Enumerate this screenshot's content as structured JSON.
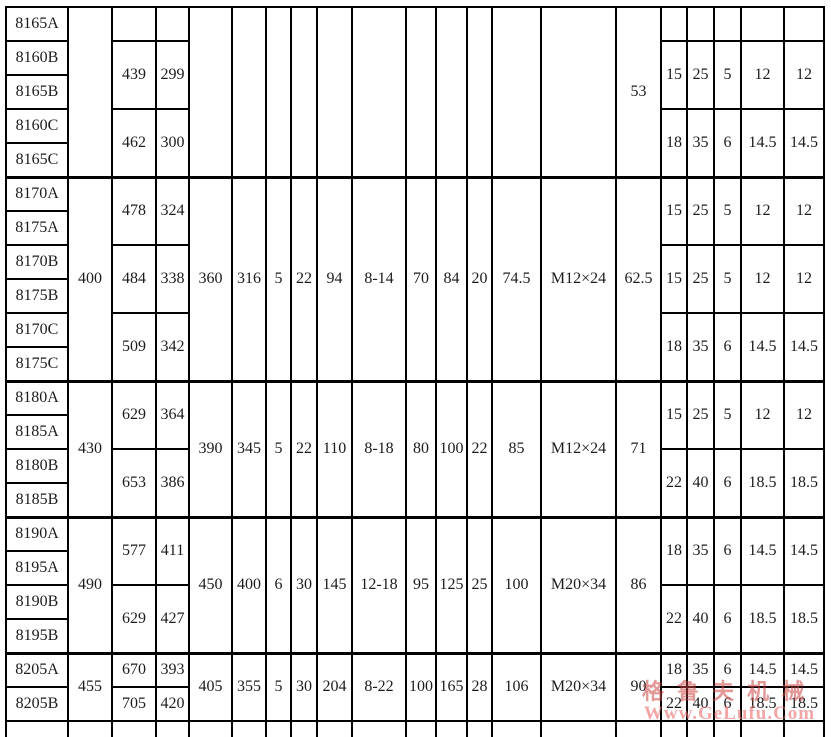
{
  "colors": {
    "grid_line": "#000000",
    "text": "#1c1c1c",
    "background": "#ffffff"
  },
  "watermark": {
    "line1": "格鲁夫机械",
    "line2": "Www.GeLufu.Com"
  },
  "table": {
    "column_count": 21,
    "column_widths": [
      62,
      44,
      44,
      33,
      43,
      34,
      25,
      26,
      35,
      54,
      30,
      31,
      25,
      49,
      75,
      45,
      26,
      27,
      27,
      43,
      40
    ],
    "default_row_height": 34,
    "rows": [
      {
        "name": "row-8165A",
        "block": false,
        "cells": [
          {
            "c": 1,
            "v": "8165A",
            "rs": 1
          },
          {
            "c": 2,
            "v": "",
            "rs": 5
          },
          {
            "c": 3,
            "v": "",
            "rs": 1
          },
          {
            "c": 4,
            "v": "",
            "rs": 1
          },
          {
            "c": 5,
            "v": "",
            "rs": 5
          },
          {
            "c": 6,
            "v": "",
            "rs": 5
          },
          {
            "c": 7,
            "v": "",
            "rs": 5
          },
          {
            "c": 8,
            "v": "",
            "rs": 5
          },
          {
            "c": 9,
            "v": "",
            "rs": 5
          },
          {
            "c": 10,
            "v": "",
            "rs": 5
          },
          {
            "c": 11,
            "v": "",
            "rs": 5
          },
          {
            "c": 12,
            "v": "",
            "rs": 5
          },
          {
            "c": 13,
            "v": "",
            "rs": 5
          },
          {
            "c": 14,
            "v": "",
            "rs": 5
          },
          {
            "c": 15,
            "v": "",
            "rs": 5
          },
          {
            "c": 16,
            "v": "53",
            "rs": 5,
            "top": true
          },
          {
            "c": 17,
            "v": "",
            "rs": 1
          },
          {
            "c": 18,
            "v": "",
            "rs": 1
          },
          {
            "c": 19,
            "v": "",
            "rs": 1
          },
          {
            "c": 20,
            "v": "",
            "rs": 1
          },
          {
            "c": 21,
            "v": "",
            "rs": 1
          }
        ]
      },
      {
        "name": "row-8160B",
        "block": false,
        "cells": [
          {
            "c": 1,
            "v": "8160B",
            "rs": 1
          },
          {
            "c": 3,
            "v": "439",
            "rs": 2
          },
          {
            "c": 4,
            "v": "299",
            "rs": 2
          },
          {
            "c": 17,
            "v": "15",
            "rs": 2
          },
          {
            "c": 18,
            "v": "25",
            "rs": 2
          },
          {
            "c": 19,
            "v": "5",
            "rs": 2
          },
          {
            "c": 20,
            "v": "12",
            "rs": 2
          },
          {
            "c": 21,
            "v": "12",
            "rs": 2
          }
        ]
      },
      {
        "name": "row-8165B",
        "block": false,
        "cells": [
          {
            "c": 1,
            "v": "8165B",
            "rs": 1
          }
        ]
      },
      {
        "name": "row-8160C",
        "block": false,
        "cells": [
          {
            "c": 1,
            "v": "8160C",
            "rs": 1
          },
          {
            "c": 3,
            "v": "462",
            "rs": 2
          },
          {
            "c": 4,
            "v": "300",
            "rs": 2
          },
          {
            "c": 17,
            "v": "18",
            "rs": 2
          },
          {
            "c": 18,
            "v": "35",
            "rs": 2
          },
          {
            "c": 19,
            "v": "6",
            "rs": 2
          },
          {
            "c": 20,
            "v": "14.5",
            "rs": 2
          },
          {
            "c": 21,
            "v": "14.5",
            "rs": 2
          }
        ]
      },
      {
        "name": "row-8165C",
        "block": false,
        "cells": [
          {
            "c": 1,
            "v": "8165C",
            "rs": 1
          }
        ]
      },
      {
        "name": "row-8170A",
        "block": true,
        "cells": [
          {
            "c": 1,
            "v": "8170A",
            "rs": 1
          },
          {
            "c": 2,
            "v": "400",
            "rs": 6
          },
          {
            "c": 3,
            "v": "478",
            "rs": 2
          },
          {
            "c": 4,
            "v": "324",
            "rs": 2
          },
          {
            "c": 5,
            "v": "360",
            "rs": 6
          },
          {
            "c": 6,
            "v": "316",
            "rs": 6
          },
          {
            "c": 7,
            "v": "5",
            "rs": 6
          },
          {
            "c": 8,
            "v": "22",
            "rs": 6
          },
          {
            "c": 9,
            "v": "94",
            "rs": 6
          },
          {
            "c": 10,
            "v": "8-14",
            "rs": 6
          },
          {
            "c": 11,
            "v": "70",
            "rs": 6
          },
          {
            "c": 12,
            "v": "84",
            "rs": 6
          },
          {
            "c": 13,
            "v": "20",
            "rs": 6
          },
          {
            "c": 14,
            "v": "74.5",
            "rs": 6
          },
          {
            "c": 15,
            "v": "M12×24",
            "rs": 6
          },
          {
            "c": 16,
            "v": "62.5",
            "rs": 6
          },
          {
            "c": 17,
            "v": "15",
            "rs": 2
          },
          {
            "c": 18,
            "v": "25",
            "rs": 2
          },
          {
            "c": 19,
            "v": "5",
            "rs": 2
          },
          {
            "c": 20,
            "v": "12",
            "rs": 2
          },
          {
            "c": 21,
            "v": "12",
            "rs": 2
          }
        ]
      },
      {
        "name": "row-8175A",
        "block": false,
        "cells": [
          {
            "c": 1,
            "v": "8175A",
            "rs": 1
          }
        ]
      },
      {
        "name": "row-8170B",
        "block": false,
        "cells": [
          {
            "c": 1,
            "v": "8170B",
            "rs": 1
          },
          {
            "c": 3,
            "v": "484",
            "rs": 2
          },
          {
            "c": 4,
            "v": "338",
            "rs": 2
          },
          {
            "c": 17,
            "v": "15",
            "rs": 2
          },
          {
            "c": 18,
            "v": "25",
            "rs": 2
          },
          {
            "c": 19,
            "v": "5",
            "rs": 2
          },
          {
            "c": 20,
            "v": "12",
            "rs": 2
          },
          {
            "c": 21,
            "v": "12",
            "rs": 2
          }
        ]
      },
      {
        "name": "row-8175B",
        "block": false,
        "cells": [
          {
            "c": 1,
            "v": "8175B",
            "rs": 1
          }
        ]
      },
      {
        "name": "row-8170C",
        "block": false,
        "cells": [
          {
            "c": 1,
            "v": "8170C",
            "rs": 1
          },
          {
            "c": 3,
            "v": "509",
            "rs": 2
          },
          {
            "c": 4,
            "v": "342",
            "rs": 2
          },
          {
            "c": 17,
            "v": "18",
            "rs": 2
          },
          {
            "c": 18,
            "v": "35",
            "rs": 2
          },
          {
            "c": 19,
            "v": "6",
            "rs": 2
          },
          {
            "c": 20,
            "v": "14.5",
            "rs": 2
          },
          {
            "c": 21,
            "v": "14.5",
            "rs": 2
          }
        ]
      },
      {
        "name": "row-8175C",
        "block": false,
        "cells": [
          {
            "c": 1,
            "v": "8175C",
            "rs": 1
          }
        ]
      },
      {
        "name": "row-8180A",
        "block": true,
        "cells": [
          {
            "c": 1,
            "v": "8180A",
            "rs": 1
          },
          {
            "c": 2,
            "v": "430",
            "rs": 4
          },
          {
            "c": 3,
            "v": "629",
            "rs": 2
          },
          {
            "c": 4,
            "v": "364",
            "rs": 2
          },
          {
            "c": 5,
            "v": "390",
            "rs": 4
          },
          {
            "c": 6,
            "v": "345",
            "rs": 4
          },
          {
            "c": 7,
            "v": "5",
            "rs": 4
          },
          {
            "c": 8,
            "v": "22",
            "rs": 4
          },
          {
            "c": 9,
            "v": "110",
            "rs": 4
          },
          {
            "c": 10,
            "v": "8-18",
            "rs": 4
          },
          {
            "c": 11,
            "v": "80",
            "rs": 4
          },
          {
            "c": 12,
            "v": "100",
            "rs": 4
          },
          {
            "c": 13,
            "v": "22",
            "rs": 4
          },
          {
            "c": 14,
            "v": "85",
            "rs": 4
          },
          {
            "c": 15,
            "v": "M12×24",
            "rs": 4
          },
          {
            "c": 16,
            "v": "71",
            "rs": 4
          },
          {
            "c": 17,
            "v": "15",
            "rs": 2
          },
          {
            "c": 18,
            "v": "25",
            "rs": 2
          },
          {
            "c": 19,
            "v": "5",
            "rs": 2
          },
          {
            "c": 20,
            "v": "12",
            "rs": 2
          },
          {
            "c": 21,
            "v": "12",
            "rs": 2
          }
        ]
      },
      {
        "name": "row-8185A",
        "block": false,
        "cells": [
          {
            "c": 1,
            "v": "8185A",
            "rs": 1
          }
        ]
      },
      {
        "name": "row-8180B",
        "block": false,
        "cells": [
          {
            "c": 1,
            "v": "8180B",
            "rs": 1
          },
          {
            "c": 3,
            "v": "653",
            "rs": 2
          },
          {
            "c": 4,
            "v": "386",
            "rs": 2
          },
          {
            "c": 17,
            "v": "22",
            "rs": 2
          },
          {
            "c": 18,
            "v": "40",
            "rs": 2
          },
          {
            "c": 19,
            "v": "6",
            "rs": 2
          },
          {
            "c": 20,
            "v": "18.5",
            "rs": 2
          },
          {
            "c": 21,
            "v": "18.5",
            "rs": 2
          }
        ]
      },
      {
        "name": "row-8185B",
        "block": false,
        "cells": [
          {
            "c": 1,
            "v": "8185B",
            "rs": 1
          }
        ]
      },
      {
        "name": "row-8190A",
        "block": true,
        "cells": [
          {
            "c": 1,
            "v": "8190A",
            "rs": 1
          },
          {
            "c": 2,
            "v": "490",
            "rs": 4
          },
          {
            "c": 3,
            "v": "577",
            "rs": 2
          },
          {
            "c": 4,
            "v": "411",
            "rs": 2
          },
          {
            "c": 5,
            "v": "450",
            "rs": 4
          },
          {
            "c": 6,
            "v": "400",
            "rs": 4
          },
          {
            "c": 7,
            "v": "6",
            "rs": 4
          },
          {
            "c": 8,
            "v": "30",
            "rs": 4
          },
          {
            "c": 9,
            "v": "145",
            "rs": 4
          },
          {
            "c": 10,
            "v": "12-18",
            "rs": 4
          },
          {
            "c": 11,
            "v": "95",
            "rs": 4
          },
          {
            "c": 12,
            "v": "125",
            "rs": 4
          },
          {
            "c": 13,
            "v": "25",
            "rs": 4
          },
          {
            "c": 14,
            "v": "100",
            "rs": 4
          },
          {
            "c": 15,
            "v": "M20×34",
            "rs": 4
          },
          {
            "c": 16,
            "v": "86",
            "rs": 4
          },
          {
            "c": 17,
            "v": "18",
            "rs": 2
          },
          {
            "c": 18,
            "v": "35",
            "rs": 2
          },
          {
            "c": 19,
            "v": "6",
            "rs": 2
          },
          {
            "c": 20,
            "v": "14.5",
            "rs": 2
          },
          {
            "c": 21,
            "v": "14.5",
            "rs": 2
          }
        ]
      },
      {
        "name": "row-8195A",
        "block": false,
        "cells": [
          {
            "c": 1,
            "v": "8195A",
            "rs": 1
          }
        ]
      },
      {
        "name": "row-8190B",
        "block": false,
        "cells": [
          {
            "c": 1,
            "v": "8190B",
            "rs": 1
          },
          {
            "c": 3,
            "v": "629",
            "rs": 2
          },
          {
            "c": 4,
            "v": "427",
            "rs": 2
          },
          {
            "c": 17,
            "v": "22",
            "rs": 2
          },
          {
            "c": 18,
            "v": "40",
            "rs": 2
          },
          {
            "c": 19,
            "v": "6",
            "rs": 2
          },
          {
            "c": 20,
            "v": "18.5",
            "rs": 2
          },
          {
            "c": 21,
            "v": "18.5",
            "rs": 2
          }
        ]
      },
      {
        "name": "row-8195B",
        "block": false,
        "cells": [
          {
            "c": 1,
            "v": "8195B",
            "rs": 1
          }
        ]
      },
      {
        "name": "row-8205A",
        "block": true,
        "cells": [
          {
            "c": 1,
            "v": "8205A",
            "rs": 1
          },
          {
            "c": 2,
            "v": "455",
            "rs": 2
          },
          {
            "c": 3,
            "v": "670",
            "rs": 1
          },
          {
            "c": 4,
            "v": "393",
            "rs": 1
          },
          {
            "c": 5,
            "v": "405",
            "rs": 2
          },
          {
            "c": 6,
            "v": "355",
            "rs": 2
          },
          {
            "c": 7,
            "v": "5",
            "rs": 2
          },
          {
            "c": 8,
            "v": "30",
            "rs": 2
          },
          {
            "c": 9,
            "v": "204",
            "rs": 2
          },
          {
            "c": 10,
            "v": "8-22",
            "rs": 2
          },
          {
            "c": 11,
            "v": "100",
            "rs": 2
          },
          {
            "c": 12,
            "v": "165",
            "rs": 2
          },
          {
            "c": 13,
            "v": "28",
            "rs": 2
          },
          {
            "c": 14,
            "v": "106",
            "rs": 2
          },
          {
            "c": 15,
            "v": "M20×34",
            "rs": 2
          },
          {
            "c": 16,
            "v": "90",
            "rs": 2
          },
          {
            "c": 17,
            "v": "18",
            "rs": 1
          },
          {
            "c": 18,
            "v": "35",
            "rs": 1
          },
          {
            "c": 19,
            "v": "6",
            "rs": 1
          },
          {
            "c": 20,
            "v": "14.5",
            "rs": 1
          },
          {
            "c": 21,
            "v": "14.5",
            "rs": 1
          }
        ]
      },
      {
        "name": "row-8205B",
        "block": false,
        "cells": [
          {
            "c": 1,
            "v": "8205B",
            "rs": 1
          },
          {
            "c": 3,
            "v": "705",
            "rs": 1
          },
          {
            "c": 4,
            "v": "420",
            "rs": 1
          },
          {
            "c": 17,
            "v": "22",
            "rs": 1
          },
          {
            "c": 18,
            "v": "40",
            "rs": 1
          },
          {
            "c": 19,
            "v": "6",
            "rs": 1
          },
          {
            "c": 20,
            "v": "18.5",
            "rs": 1
          },
          {
            "c": 21,
            "v": "18.5",
            "rs": 1
          }
        ]
      },
      {
        "name": "row-partial-cut",
        "block": false,
        "cut": true,
        "h": 26,
        "cells": [
          {
            "c": 1,
            "v": "",
            "rs": 1
          },
          {
            "c": 2,
            "v": "",
            "rs": 1
          },
          {
            "c": 3,
            "v": "",
            "rs": 1
          },
          {
            "c": 4,
            "v": "",
            "rs": 1
          },
          {
            "c": 5,
            "v": "",
            "rs": 1
          },
          {
            "c": 6,
            "v": "",
            "rs": 1
          },
          {
            "c": 7,
            "v": "",
            "rs": 1
          },
          {
            "c": 8,
            "v": "",
            "rs": 1
          },
          {
            "c": 9,
            "v": "",
            "rs": 1
          },
          {
            "c": 10,
            "v": "",
            "rs": 1
          },
          {
            "c": 11,
            "v": "",
            "rs": 1
          },
          {
            "c": 12,
            "v": "",
            "rs": 1
          },
          {
            "c": 13,
            "v": "",
            "rs": 1
          },
          {
            "c": 14,
            "v": "",
            "rs": 1
          },
          {
            "c": 15,
            "v": "",
            "rs": 1
          },
          {
            "c": 16,
            "v": "",
            "rs": 1
          },
          {
            "c": 17,
            "v": "",
            "rs": 1
          },
          {
            "c": 18,
            "v": "",
            "rs": 1
          },
          {
            "c": 19,
            "v": "",
            "rs": 1
          },
          {
            "c": 20,
            "v": "",
            "rs": 1
          },
          {
            "c": 21,
            "v": "",
            "rs": 1
          }
        ]
      }
    ]
  }
}
